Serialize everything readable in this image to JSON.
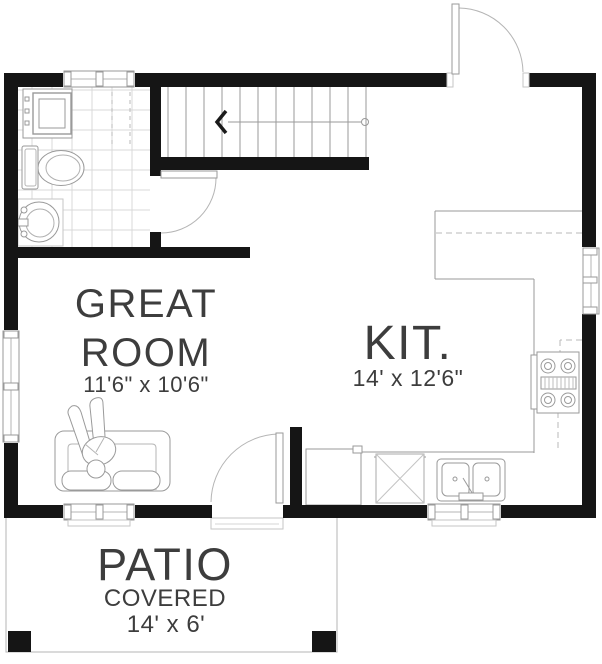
{
  "floor_plan": {
    "type": "residential-floor-plan",
    "rooms": {
      "great_room": {
        "name_line1": "GREAT",
        "name_line2": "ROOM",
        "dimensions": "11'6\" x 10'6\""
      },
      "kitchen": {
        "name": "KIT.",
        "dimensions": "14' x 12'6\""
      },
      "patio": {
        "name": "PATIO",
        "descriptor": "COVERED",
        "dimensions": "14' x 6'"
      }
    },
    "fixtures": {
      "bathroom": [
        "washer-dryer",
        "toilet",
        "pedestal-sink",
        "tile-floor"
      ],
      "kitchen": [
        "peninsula-counter",
        "upper-cabinets-dashed",
        "range",
        "refrigerator",
        "dishwasher",
        "double-bowl-sink"
      ],
      "great_room": [
        "sofa",
        "person-on-sofa"
      ],
      "stairs": [
        "staircase",
        "stair-direction-arrow"
      ],
      "patio": [
        "patio-outline",
        "patio-post-left",
        "patio-post-right",
        "door-threshold"
      ],
      "doors": [
        "entry-door",
        "bathroom-door",
        "patio-door"
      ],
      "windows": [
        "top-wall-window",
        "left-wall-window",
        "right-wall-window",
        "bottom-wall-window-great-room",
        "bottom-wall-window-kitchen"
      ]
    },
    "colors": {
      "wall": "#151515",
      "fixture_line": "#9a9a9a",
      "light_line": "#c6c6c6",
      "tile_line": "#d8d8d8",
      "text": "#3d3d3d",
      "background": "#ffffff"
    }
  }
}
